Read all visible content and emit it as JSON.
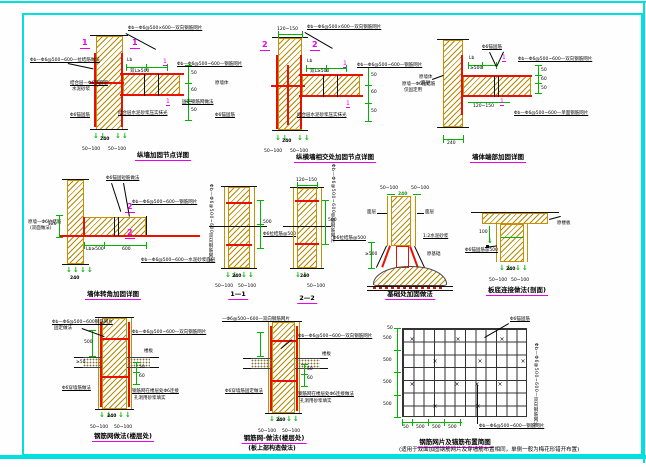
{
  "frame": {
    "color": "#00e0e0"
  },
  "glyphs": {
    "down_arrows": "↓↓",
    "down_arrow": "↓",
    "x_mark": "×"
  },
  "d1": {
    "marker_left": "1",
    "marker_right": "1",
    "cut": "1",
    "top": "Φb—Φ6@500×600—双向钢筋网片",
    "left1": "Φb—Φ6@500~600—拉结筋做法",
    "left2a": "结合层—Φ6钢筋网",
    "left2b": "水泥砂浆",
    "left3": "Φ6锚固筋",
    "beam_lbl": "结合层水泥砂浆压实抹光",
    "r1": "Φb—Φ6@500~600—钢筋网片",
    "r2": "固定钢筋网做法",
    "lb": "Lb",
    "lb2": "双L≥500",
    "dim_mid": "240",
    "dim_a": "50~100",
    "dim_b": "50~100",
    "d50": "50",
    "d60": "60",
    "d50b": "50",
    "caption": "纵墙加固节点详图"
  },
  "d2": {
    "marker_left": "2",
    "marker_right": "2",
    "cut": "1",
    "top": "Φb—Φ6@500×600—双向钢筋网片",
    "top_dim": "120~150",
    "left1": "原墙体",
    "left2": "Φ6锚固筋",
    "beam_lbl": "结合层水泥砂浆压实抹光",
    "r1": "Φb—Φ6@500~600—钢筋网片",
    "r2a": "原墙—Φ6拉结筋",
    "r2b": "仅固定用",
    "lb": "Lb",
    "lb2": "双L≥500",
    "dim_mid": "240",
    "dim_a": "50~100",
    "dim_b": "50~100",
    "d50": "50",
    "d60": "60",
    "d50b": "50",
    "caption": "纵横墙相交处加固节点详图"
  },
  "d3": {
    "cut": "1",
    "top": "Φ6锚固筋",
    "r1": "Φb—Φ6@500~600—双向钢筋网片",
    "r2": "Φb—Φ6@500~600—单面钢筋网片",
    "left1": "原墙体",
    "left2": "面层",
    "lb": "Lb",
    "lb2": "≥500",
    "dim_b": "120~150",
    "dim_wall": "240",
    "d50": "50",
    "d60": "60",
    "d50b": "50",
    "caption": "墙体端部加固详图"
  },
  "d4": {
    "marker_up": "2",
    "marker_dn": "2",
    "top": "Φ6锚固短筋做法",
    "r1": "Φb—Φ6@500~600—钢筋网片",
    "r2": "Φb—Φ6@500~600—水泥砂浆面层",
    "left1a": "原墙—Φ6拉结筋",
    "left1b": "(双面做法)",
    "lb": "Lb≥500",
    "dim_b": "600",
    "dim_wall": "240",
    "dim_l": "120",
    "caption": "墙体转角加固详图"
  },
  "d5": {
    "vtext": "Φb—Φ6@500~600双向钢筋网片",
    "r1": "Φ6拉结筋@500",
    "dim_v": "500",
    "dim_mid": "240",
    "dim_a": "50~100",
    "dim_b": "50~100",
    "caption": "1—1"
  },
  "d6": {
    "vtext": "Φb—Φ6@500~600单面钢筋网片",
    "top_dim": "120~150",
    "r1": "Φ6拉结筋@500",
    "dim_v": "500",
    "dim_mid": "240",
    "dim_b": "50~100",
    "caption": "2—2"
  },
  "d7": {
    "dim_a": "50~100",
    "dim_b": "50~100",
    "dim_mid": "240",
    "left1": "面层",
    "right1": "面层",
    "r2": "1:2水泥砂浆",
    "r3": "原基础",
    "dim_v": "≥500",
    "caption": "基础处加固做法"
  },
  "d8": {
    "right1": "原楼板",
    "left1": "Φ6锚固筋@500",
    "dim_v": "100",
    "dim_mid": "240",
    "dim_a": "50~100",
    "dim_b": "50~100",
    "caption": "板底连接做法(剖面)"
  },
  "d9": {
    "top1a": "Φb—Φ6@500~600钢筋网片",
    "top1b": "固定做法",
    "top2": "Φb—Φ6@500~600—双向钢筋网片",
    "right1": "楼板",
    "left_dim": "≥50",
    "left2": "Φ6穿墙筋做法",
    "r2a": "钢筋网在楼层处Φ6连接",
    "r2b": "孔洞用砂浆填实",
    "d50": "50",
    "d60": "60",
    "dim_v": "500",
    "dim_mid": "240",
    "dim_a": "50~100",
    "dim_b": "50~100",
    "caption": "钢筋网做法(楼层处)"
  },
  "d10": {
    "top1": "—Φ6@500~600—双向钢筋网片",
    "top2": "Φb—Φ6@500~600—双向钢筋网片",
    "right1": "楼板",
    "left2": "Φ6穿墙筋固定做法",
    "r2a": "钢筋网在楼层处Φ6连接做法",
    "r2b": "孔洞用砂浆填实",
    "d50": "50",
    "d60": "60",
    "dim_mid": "240",
    "dim_a": "50~100",
    "dim_b": "50~100",
    "caption1": "钢筋网-做法(楼层处)",
    "caption2": "(板上部构造做法)"
  },
  "plan": {
    "label_top": "Φ6锚固筋",
    "label_right": "Φb—Φ6@500~600—双向钢筋网片",
    "label_bottom": "Φb—Φ6@500~600—钢筋网片",
    "dims_left": [
      "500",
      "500",
      "500",
      "500"
    ],
    "dim_left_top": "50",
    "dims_bottom": [
      "50",
      "500",
      "500",
      "500"
    ],
    "caption": "钢筋网片及锚筋布置简图",
    "note": "(适用于双面加固钢筋网片及穿墙筋布置相同，单侧一般为梅花形错开布置)"
  }
}
